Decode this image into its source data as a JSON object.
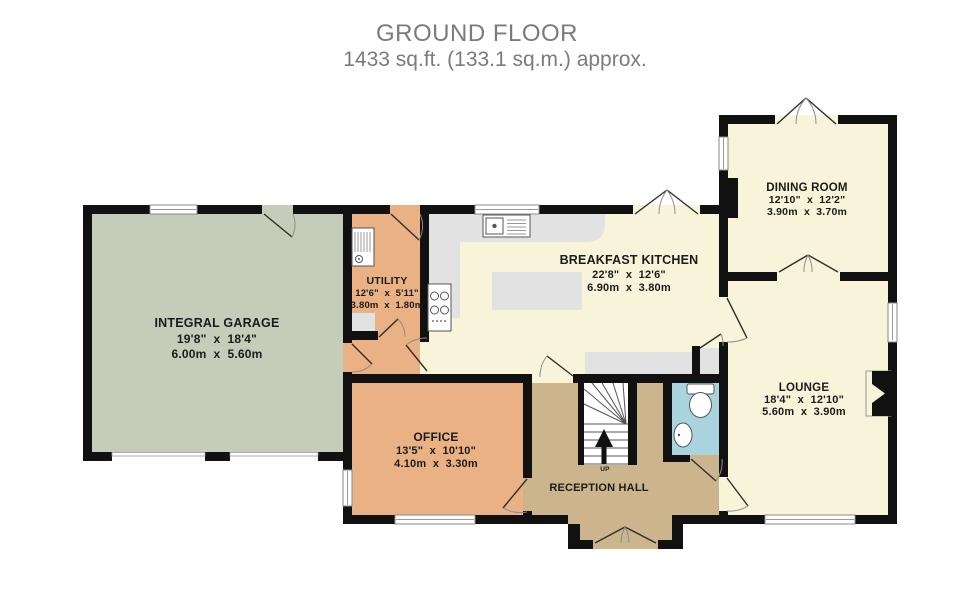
{
  "title": {
    "line1": "GROUND FLOOR",
    "line2": "1433 sq.ft. (133.1 sq.m.) approx."
  },
  "rooms": {
    "garage": {
      "name": "INTEGRAL GARAGE",
      "imperial": "19'8\"  x  18'4\"",
      "metric": "6.00m  x  5.60m"
    },
    "utility": {
      "name": "UTILITY",
      "imperial": "12'6\"  x  5'11\"",
      "metric": "3.80m  x  1.80m"
    },
    "kitchen": {
      "name": "BREAKFAST KITCHEN",
      "imperial": "22'8\"  x  12'6\"",
      "metric": "6.90m  x  3.80m"
    },
    "dining": {
      "name": "DINING ROOM",
      "imperial": "12'10\"  x  12'2\"",
      "metric": "3.90m  x  3.70m"
    },
    "lounge": {
      "name": "LOUNGE",
      "imperial": "18'4\"  x  12'10\"",
      "metric": "5.60m  x  3.90m"
    },
    "office": {
      "name": "OFFICE",
      "imperial": "13'5\"  x  10'10\"",
      "metric": "4.10m  x  3.30m"
    },
    "reception": {
      "name": "RECEPTION HALL"
    }
  },
  "stairs": {
    "direction_label": "UP"
  },
  "colors": {
    "wall": "#111111",
    "garage_floor": "#c6ccba",
    "utility_floor": "#e9b184",
    "office_floor": "#e9b184",
    "living_floor": "#f8f4da",
    "hall_floor": "#ccb48c",
    "bathroom_floor": "#a9d4dd",
    "counter": "#e2e2e2",
    "title_text": "#7b7b7b"
  }
}
